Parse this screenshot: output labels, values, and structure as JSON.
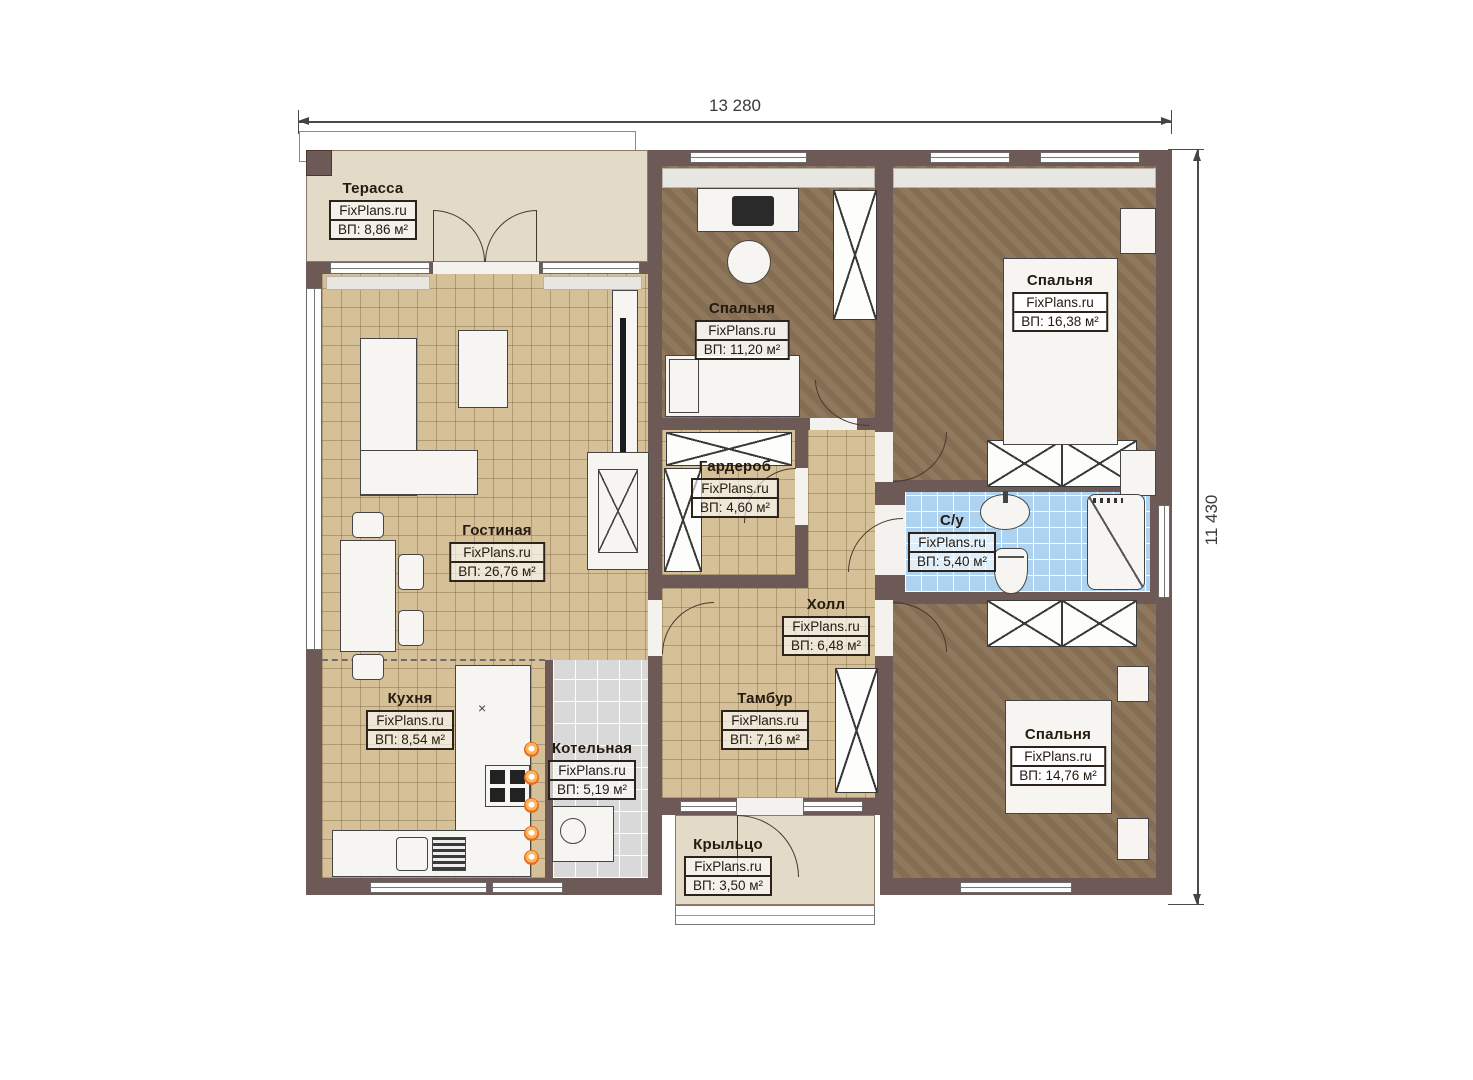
{
  "dimensions": {
    "top": "13 280",
    "right": "11 430"
  },
  "rooms": {
    "terrace": {
      "name": "Терасса",
      "brand": "FixPlans.ru",
      "area": "ВП: 8,86 м²"
    },
    "living": {
      "name": "Гостиная",
      "brand": "FixPlans.ru",
      "area": "ВП: 26,76 м²"
    },
    "kitchen": {
      "name": "Кухня",
      "brand": "FixPlans.ru",
      "area": "ВП: 8,54 м²"
    },
    "boiler": {
      "name": "Котельная",
      "brand": "FixPlans.ru",
      "area": "ВП: 5,19 м²"
    },
    "bedroom1": {
      "name": "Спальня",
      "brand": "FixPlans.ru",
      "area": "ВП: 11,20 м²"
    },
    "wardrobe": {
      "name": "Гардероб",
      "brand": "FixPlans.ru",
      "area": "ВП: 4,60 м²"
    },
    "hall": {
      "name": "Холл",
      "brand": "FixPlans.ru",
      "area": "ВП: 6,48 м²"
    },
    "vestibule": {
      "name": "Тамбур",
      "brand": "FixPlans.ru",
      "area": "ВП: 7,16 м²"
    },
    "porch": {
      "name": "Крыльцо",
      "brand": "FixPlans.ru",
      "area": "ВП: 3,50 м²"
    },
    "bedroom2": {
      "name": "Спальня",
      "brand": "FixPlans.ru",
      "area": "ВП: 16,38 м²"
    },
    "bathroom": {
      "name": "С/у",
      "brand": "FixPlans.ru",
      "area": "ВП: 5,40 м²"
    },
    "bedroom3": {
      "name": "Спальня",
      "brand": "FixPlans.ru",
      "area": "ВП: 14,76 м²"
    }
  },
  "icons": {
    "cabinet_mark": "×"
  },
  "colors": {
    "wall": "#6d5a56",
    "tile": "#d6c097",
    "bedroom_floor": "#8b7356",
    "bath_tile": "#aed3f0",
    "boiler_tile": "#dadada",
    "terrace_floor": "#e3dac8"
  }
}
